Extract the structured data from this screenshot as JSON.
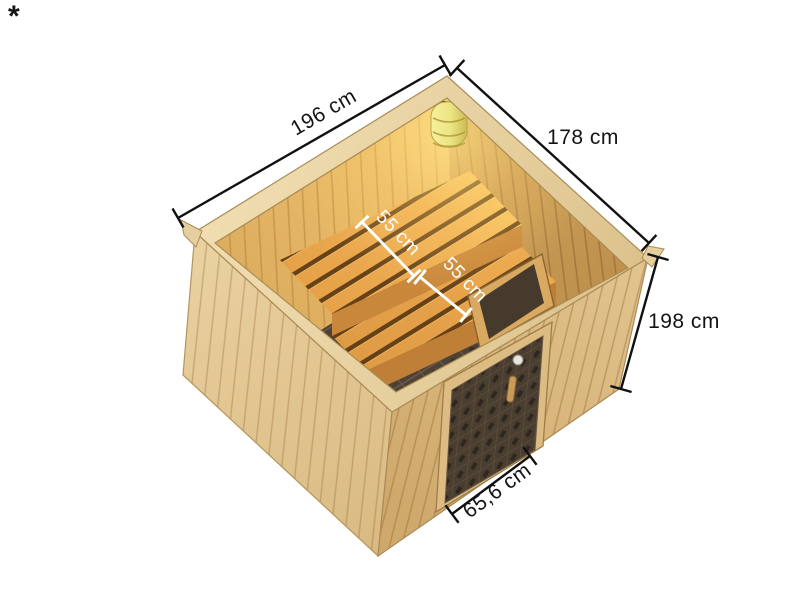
{
  "page": {
    "background": "#ffffff",
    "footnote_marker": "*"
  },
  "illustration": {
    "name": "sauna-top-isometric-view",
    "description": "3D top view of a wooden sauna cabin with glass door, two-tier bench and corner lamp, annotated with outer dimensions",
    "labels": {
      "width": "196 cm",
      "depth": "178 cm",
      "height": "198 cm",
      "door_width": "65,6 cm",
      "bench_upper_depth": "55 cm",
      "bench_lower_depth": "55 cm"
    },
    "colors": {
      "annotation_line": "#111111",
      "annotation_text": "#141414",
      "bench_annotation_line": "#ffffff",
      "wood_exterior_left": "#e6cc9b",
      "wood_exterior_right": "#ddbe88",
      "wood_rim": "#ecd7a6",
      "wood_interior_left": "#e6b866",
      "wood_interior_right": "#c99c57",
      "bench_wood": "#ecaf54",
      "bench_front": "#c9873c",
      "floor_dark": "#4e4236",
      "door_glass": "#4a3e31",
      "door_frame": "#dcbc82",
      "lamp_yellow": "#f1e98c"
    }
  }
}
